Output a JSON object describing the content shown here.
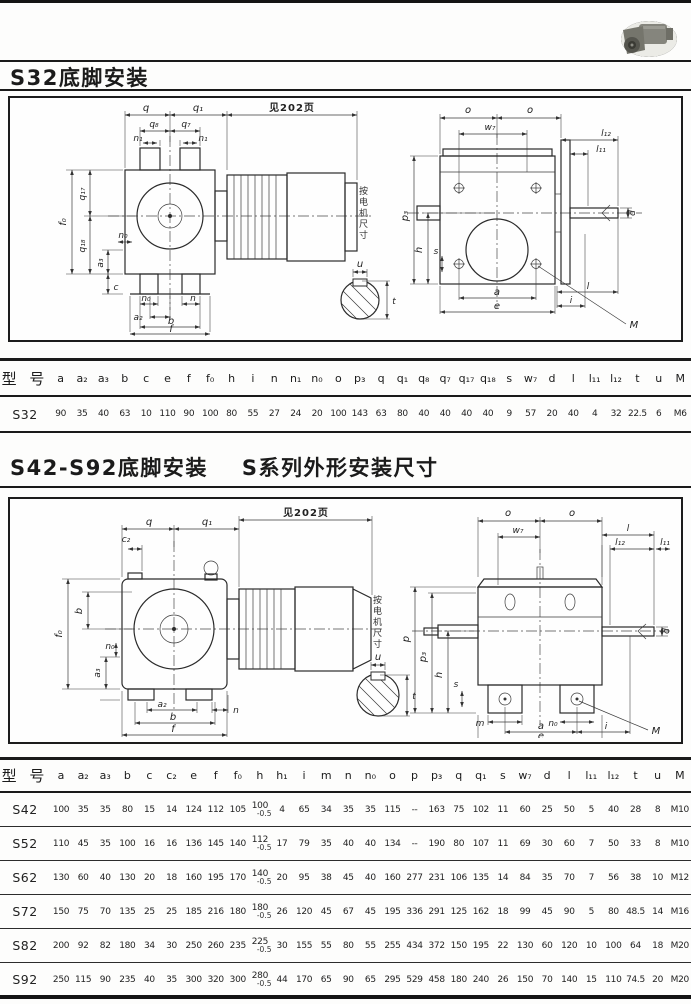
{
  "page": {
    "title1": "S32底脚安装",
    "title2a": "S42-S92底脚安装",
    "title2b": "S系列外形安装尺寸"
  },
  "drawing1": {
    "note": "见202页",
    "motor_note": "按电机尺寸",
    "labels": {
      "q": "q",
      "q1": "q₁",
      "q8": "q₈",
      "q7": "q₇",
      "n1a": "n₁",
      "n1b": "n₁",
      "f0": "f₀",
      "q17": "q₁₇",
      "q18": "q₁₈",
      "n0_side": "n₀",
      "a3": "a₃",
      "c": "c",
      "n0_bottom": "n₀",
      "n": "n",
      "a2": "a₂",
      "b": "b",
      "f": "f",
      "o1": "o",
      "o2": "o",
      "w7": "w₇",
      "l12": "l₁₂",
      "l11": "l₁₁",
      "p3": "p₃",
      "h": "h",
      "s": "s",
      "d": "d",
      "l": "l",
      "i": "i",
      "a": "a",
      "e": "e",
      "M": "M",
      "u": "u",
      "t": "t"
    }
  },
  "drawing2": {
    "note": "见202页",
    "motor_note": "按电机尺寸",
    "labels": {
      "q": "q",
      "q1": "q₁",
      "c2": "c₂",
      "f0": "f₀",
      "b_side": "b",
      "n0_side": "n₀",
      "a3": "a₃",
      "a2": "a₂",
      "n": "n",
      "b": "b",
      "f": "f",
      "o1": "o",
      "o2": "o",
      "w7": "w₇",
      "l": "l",
      "l11": "l₁₁",
      "l12": "l₁₂",
      "p": "p",
      "p3": "p₃",
      "h": "h",
      "s": "s",
      "d": "d",
      "m": "m",
      "n0_bottom": "n₀",
      "a": "a",
      "i": "i",
      "e": "e",
      "M": "M",
      "u": "u",
      "t": "t"
    }
  },
  "table1": {
    "model_header": "型 号",
    "headers": [
      "a",
      "a₂",
      "a₃",
      "b",
      "c",
      "e",
      "f",
      "f₀",
      "h",
      "i",
      "n",
      "n₁",
      "n₀",
      "o",
      "p₃",
      "q",
      "q₁",
      "q₈",
      "q₇",
      "q₁₇",
      "q₁₈",
      "s",
      "w₇",
      "d",
      "l",
      "l₁₁",
      "l₁₂",
      "t",
      "u",
      "M"
    ],
    "rows": [
      {
        "model": "S32",
        "values": [
          "90",
          "35",
          "40",
          "63",
          "10",
          "110",
          "90",
          "100",
          "80",
          "55",
          "27",
          "24",
          "20",
          "100",
          "143",
          "63",
          "80",
          "40",
          "40",
          "40",
          "40",
          "9",
          "57",
          "20",
          "40",
          "4",
          "32",
          "22.5",
          "6",
          "M6"
        ]
      }
    ]
  },
  "table2": {
    "model_header": "型 号",
    "headers": [
      "a",
      "a₂",
      "a₃",
      "b",
      "c",
      "c₂",
      "e",
      "f",
      "f₀",
      "h",
      "h₁",
      "i",
      "m",
      "n",
      "n₀",
      "o",
      "p",
      "p₃",
      "q",
      "q₁",
      "s",
      "w₇",
      "d",
      "l",
      "l₁₁",
      "l₁₂",
      "t",
      "u",
      "M"
    ],
    "rows": [
      {
        "model": "S42",
        "values": [
          "100",
          "35",
          "35",
          "80",
          "15",
          "14",
          "124",
          "112",
          "105",
          [
            "100",
            "-0.5"
          ],
          "4",
          "65",
          "34",
          "35",
          "35",
          "115",
          "--",
          "163",
          "75",
          "102",
          "11",
          "60",
          "25",
          "50",
          "5",
          "40",
          "28",
          "8",
          "M10"
        ]
      },
      {
        "model": "S52",
        "values": [
          "110",
          "45",
          "35",
          "100",
          "16",
          "16",
          "136",
          "145",
          "140",
          [
            "112",
            "-0.5"
          ],
          "17",
          "79",
          "35",
          "40",
          "40",
          "134",
          "--",
          "190",
          "80",
          "107",
          "11",
          "69",
          "30",
          "60",
          "7",
          "50",
          "33",
          "8",
          "M10"
        ]
      },
      {
        "model": "S62",
        "values": [
          "130",
          "60",
          "40",
          "130",
          "20",
          "18",
          "160",
          "195",
          "170",
          [
            "140",
            "-0.5"
          ],
          "20",
          "95",
          "38",
          "45",
          "40",
          "160",
          "277",
          "231",
          "106",
          "135",
          "14",
          "84",
          "35",
          "70",
          "7",
          "56",
          "38",
          "10",
          "M12"
        ]
      },
      {
        "model": "S72",
        "values": [
          "150",
          "75",
          "70",
          "135",
          "25",
          "25",
          "185",
          "216",
          "180",
          [
            "180",
            "-0.5"
          ],
          "26",
          "120",
          "45",
          "67",
          "45",
          "195",
          "336",
          "291",
          "125",
          "162",
          "18",
          "99",
          "45",
          "90",
          "5",
          "80",
          "48.5",
          "14",
          "M16"
        ]
      },
      {
        "model": "S82",
        "values": [
          "200",
          "92",
          "82",
          "180",
          "34",
          "30",
          "250",
          "260",
          "235",
          [
            "225",
            "-0.5"
          ],
          "30",
          "155",
          "55",
          "80",
          "55",
          "255",
          "434",
          "372",
          "150",
          "195",
          "22",
          "130",
          "60",
          "120",
          "10",
          "100",
          "64",
          "18",
          "M20"
        ]
      },
      {
        "model": "S92",
        "values": [
          "250",
          "115",
          "90",
          "235",
          "40",
          "35",
          "300",
          "320",
          "300",
          [
            "280",
            "-0.5"
          ],
          "44",
          "170",
          "65",
          "90",
          "65",
          "295",
          "529",
          "458",
          "180",
          "240",
          "26",
          "150",
          "70",
          "140",
          "15",
          "110",
          "74.5",
          "20",
          "M20"
        ]
      }
    ]
  }
}
